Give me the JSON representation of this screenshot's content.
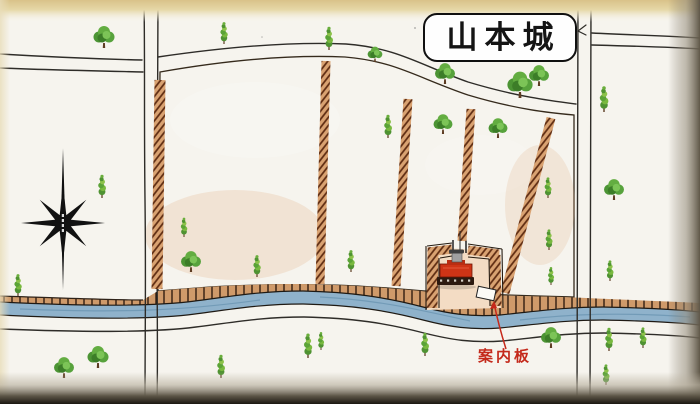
{
  "title": {
    "text": "山本城"
  },
  "annotations": {
    "info_board_label": "案内板"
  },
  "icons": {
    "compass": "compass-rose-icon",
    "shrine": "shrine-icon",
    "info_board": "info-board-icon",
    "tree_round": "tree-round-icon",
    "tree_conical": "tree-conical-icon"
  },
  "colors": {
    "paper": "#f5f2ea",
    "ground-tan": "#f0d2b3",
    "embankment-brown": "#8a4526",
    "river-blue": "#8fb2cb",
    "road-line": "#2e2c28",
    "label-red": "#c4291b",
    "tree-green": "#56a238",
    "shrine-red": "#cf3517",
    "title-ink": "#141414"
  },
  "map": {
    "trees": [
      {
        "type": "round",
        "x": 104,
        "y": 48,
        "s": 1.0
      },
      {
        "type": "conical",
        "x": 224,
        "y": 44,
        "s": 0.85
      },
      {
        "type": "conical",
        "x": 329,
        "y": 50,
        "s": 0.9
      },
      {
        "type": "round",
        "x": 375,
        "y": 62,
        "s": 0.7
      },
      {
        "type": "round",
        "x": 445,
        "y": 84,
        "s": 0.95
      },
      {
        "type": "round",
        "x": 520,
        "y": 98,
        "s": 1.2
      },
      {
        "type": "round",
        "x": 539,
        "y": 86,
        "s": 0.95
      },
      {
        "type": "conical",
        "x": 604,
        "y": 112,
        "s": 1.0
      },
      {
        "type": "round",
        "x": 614,
        "y": 200,
        "s": 0.95
      },
      {
        "type": "conical",
        "x": 610,
        "y": 281,
        "s": 0.8
      },
      {
        "type": "conical",
        "x": 102,
        "y": 198,
        "s": 0.9
      },
      {
        "type": "conical",
        "x": 18,
        "y": 296,
        "s": 0.85
      },
      {
        "type": "conical",
        "x": 184,
        "y": 237,
        "s": 0.75
      },
      {
        "type": "round",
        "x": 191,
        "y": 272,
        "s": 0.95
      },
      {
        "type": "conical",
        "x": 257,
        "y": 277,
        "s": 0.85
      },
      {
        "type": "conical",
        "x": 351,
        "y": 272,
        "s": 0.85
      },
      {
        "type": "conical",
        "x": 388,
        "y": 138,
        "s": 0.9
      },
      {
        "type": "round",
        "x": 443,
        "y": 134,
        "s": 0.9
      },
      {
        "type": "round",
        "x": 498,
        "y": 138,
        "s": 0.9
      },
      {
        "type": "conical",
        "x": 548,
        "y": 198,
        "s": 0.8
      },
      {
        "type": "conical",
        "x": 549,
        "y": 250,
        "s": 0.8
      },
      {
        "type": "conical",
        "x": 551,
        "y": 285,
        "s": 0.7
      },
      {
        "type": "round",
        "x": 64,
        "y": 378,
        "s": 0.95
      },
      {
        "type": "round",
        "x": 98,
        "y": 368,
        "s": 1.0
      },
      {
        "type": "conical",
        "x": 221,
        "y": 378,
        "s": 0.9
      },
      {
        "type": "conical",
        "x": 308,
        "y": 358,
        "s": 0.95
      },
      {
        "type": "conical",
        "x": 321,
        "y": 350,
        "s": 0.7
      },
      {
        "type": "conical",
        "x": 425,
        "y": 356,
        "s": 0.9
      },
      {
        "type": "round",
        "x": 551,
        "y": 348,
        "s": 0.95
      },
      {
        "type": "conical",
        "x": 609,
        "y": 351,
        "s": 0.9
      },
      {
        "type": "conical",
        "x": 643,
        "y": 348,
        "s": 0.8
      },
      {
        "type": "conical",
        "x": 606,
        "y": 385,
        "s": 0.8
      }
    ]
  }
}
